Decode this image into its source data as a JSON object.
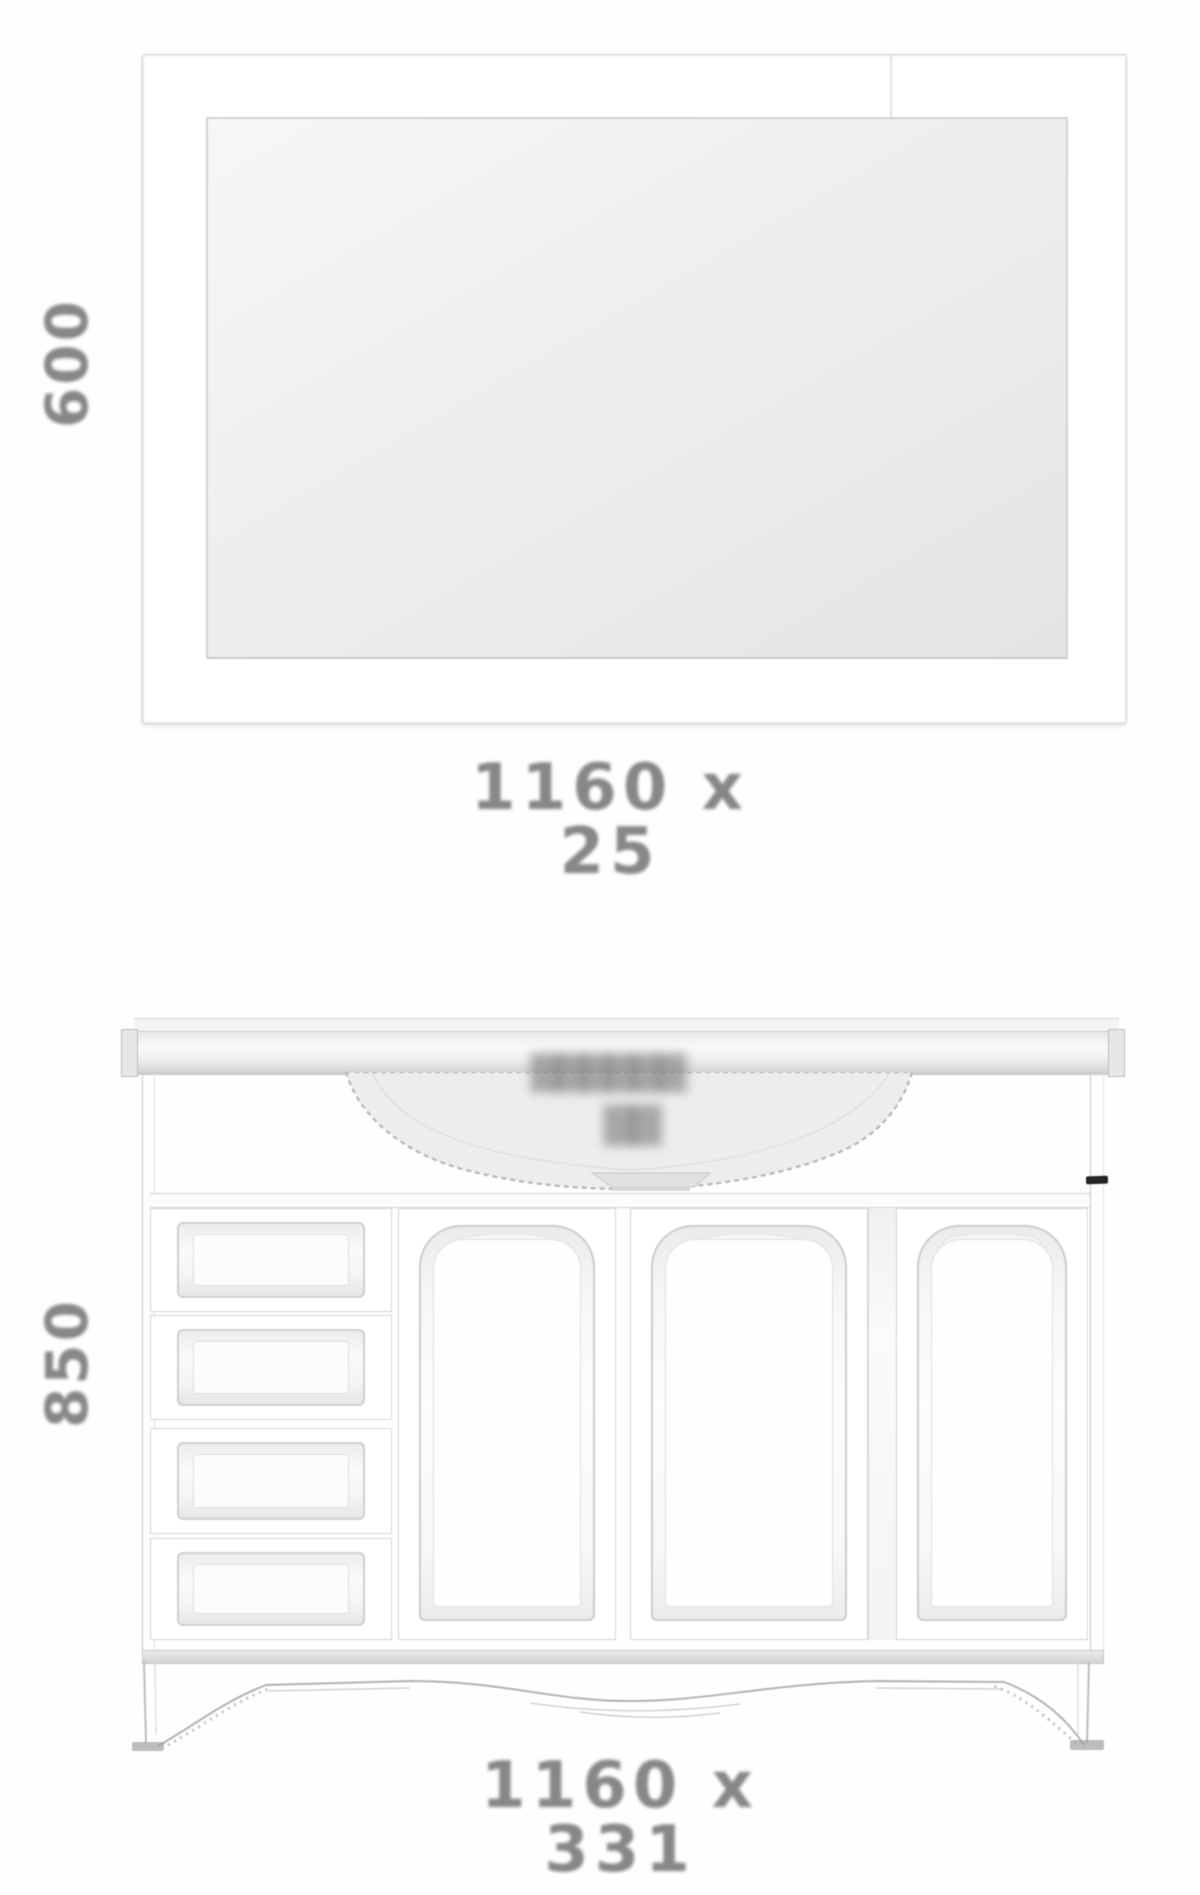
{
  "drawing": {
    "mirror": {
      "height_label": "600",
      "size_label": "1160 x 25"
    },
    "vanity": {
      "height_label": "850",
      "size_label": "1160 x 331",
      "drawer_count": 4,
      "door_count": 3,
      "sink_watermark_line1": "▇▇▇▇▇▇",
      "sink_watermark_line2": "▇▇"
    }
  },
  "colors": {
    "label_gray": "#878787",
    "line_gray": "#c9c9c9",
    "panel_fill": "#f2f2f2",
    "artifact_mark": "#232323",
    "background": "#fefefe"
  }
}
